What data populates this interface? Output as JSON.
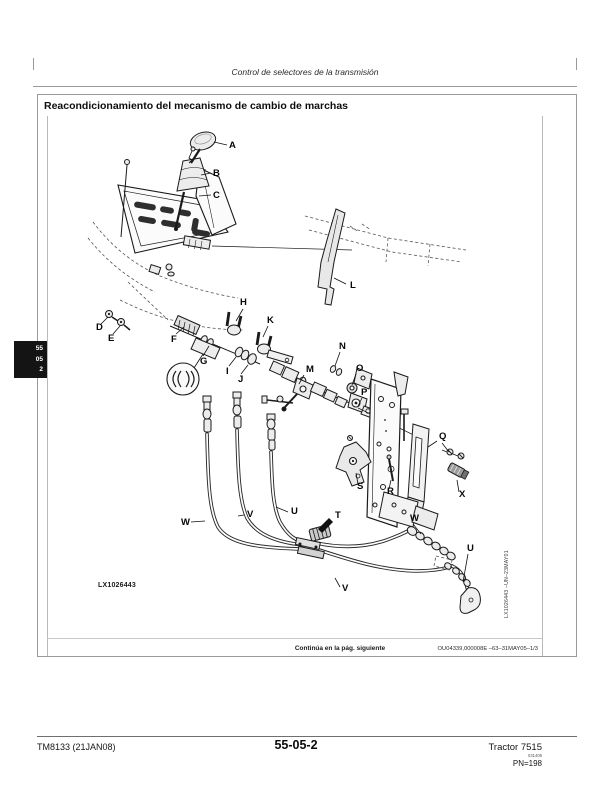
{
  "header": {
    "title": "Control de selectores de la transmisión"
  },
  "section": {
    "title": "Reacondicionamiento del mecanismo de cambio de marchas"
  },
  "tab": {
    "lines": [
      "55",
      "05",
      "2"
    ]
  },
  "figure": {
    "id_caption": "LX1026443",
    "side_caption": "LX1026443  –UN–23MAY01",
    "labels": [
      {
        "text": "A"
      },
      {
        "text": "B"
      },
      {
        "text": "C"
      },
      {
        "text": "D"
      },
      {
        "text": "E"
      },
      {
        "text": "F"
      },
      {
        "text": "G"
      },
      {
        "text": "H"
      },
      {
        "text": "I"
      },
      {
        "text": "J"
      },
      {
        "text": "K"
      },
      {
        "text": "L"
      },
      {
        "text": "M"
      },
      {
        "text": "N"
      },
      {
        "text": "O"
      },
      {
        "text": "P"
      },
      {
        "text": "Q"
      },
      {
        "text": "R"
      },
      {
        "text": "S"
      },
      {
        "text": "T"
      },
      {
        "text": "U"
      },
      {
        "text": "V"
      },
      {
        "text": "W"
      },
      {
        "text": "W"
      },
      {
        "text": "U"
      },
      {
        "text": "V"
      },
      {
        "text": "X"
      }
    ]
  },
  "caption_strip": {
    "continuation": "Continúa en la pág. siguiente",
    "code": "OU04339,000008E  –63–31MAY05–1/3"
  },
  "footer": {
    "doc": "TM8133 (21JAN08)",
    "page": "55-05-2",
    "model": "Tractor 7515",
    "print_code": "031408",
    "pn": "PN=198"
  }
}
